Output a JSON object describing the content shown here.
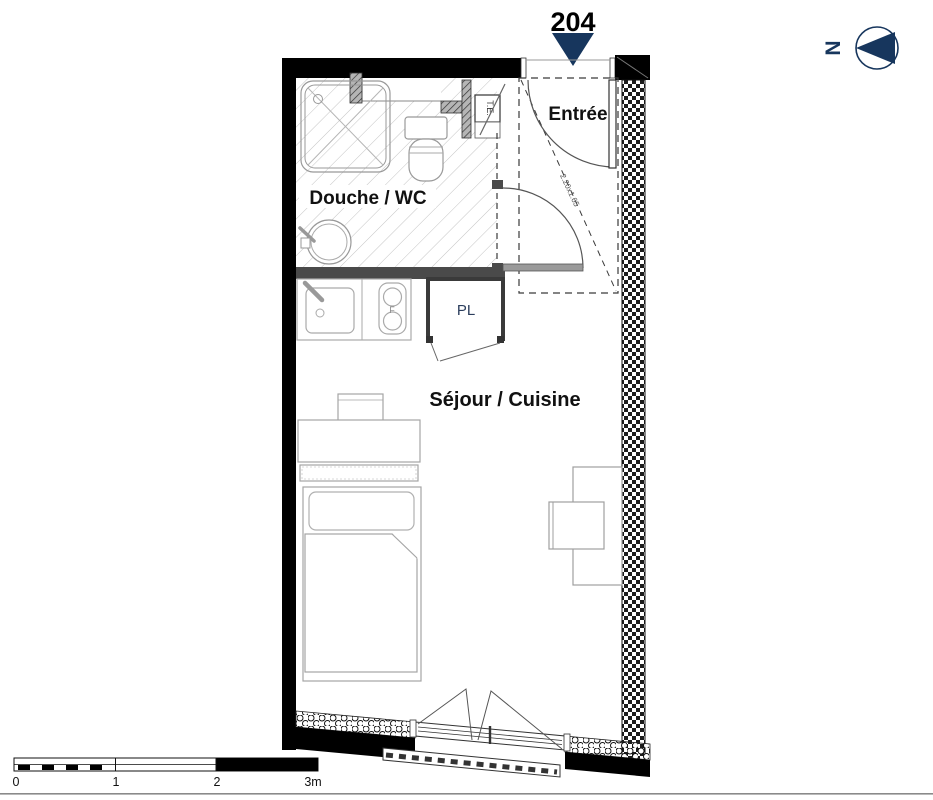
{
  "title": {
    "unit_number": "204"
  },
  "compass": {
    "north_label": "N"
  },
  "rooms": {
    "entrance": {
      "label": "Entrée"
    },
    "bathroom": {
      "label": "Douche / WC"
    },
    "living_kitchen": {
      "label": "Séjour / Cuisine"
    },
    "closet": {
      "label": "PL"
    },
    "electrical_panel": {
      "label": "T.E."
    }
  },
  "annotations": {
    "entrance_zone_dimension": "2.20x1.65"
  },
  "scale_bar": {
    "ticks": [
      "0",
      "1",
      "2",
      "3m"
    ]
  },
  "colors": {
    "navy": "#17365d",
    "wall_black": "#000000",
    "partition_gray": "#4a4a4a",
    "furniture_gray": "#9a9a9a",
    "hatch_gray": "#c4c4c4"
  }
}
